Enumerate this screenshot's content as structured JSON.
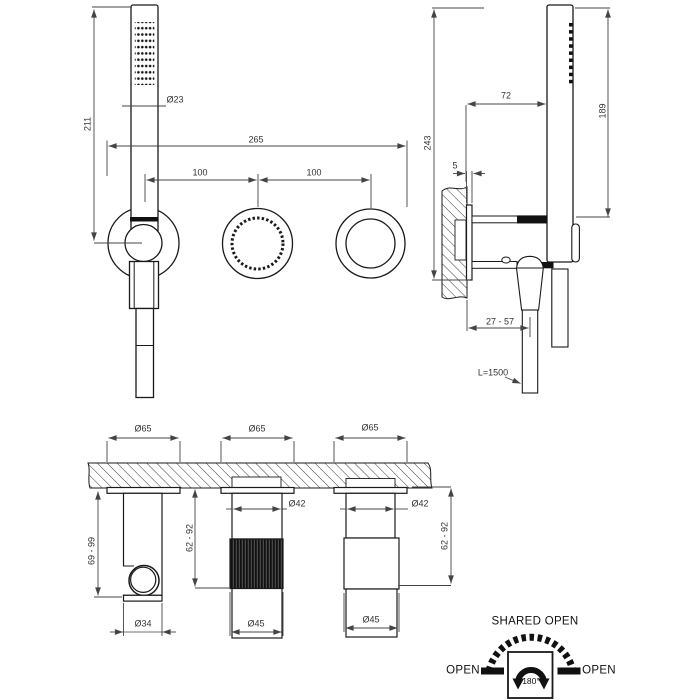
{
  "front_view": {
    "overall_height": "211",
    "handshower_diameter": "Ø23",
    "overall_width": "265",
    "spacing_left": "100",
    "spacing_right": "100"
  },
  "side_view": {
    "overall_height": "243",
    "wall_to_handshower": "72",
    "plate_thickness": "5",
    "handshower_height": "189",
    "depth_range": "27 - 57",
    "hose_length": "L=1500"
  },
  "bottom_view": {
    "flange_diameter_left": "Ø65",
    "flange_diameter_middle": "Ø65",
    "flange_diameter_right": "Ø65",
    "body_diameter_middle": "Ø42",
    "body_diameter_right": "Ø42",
    "knob_diameter_middle": "Ø45",
    "knob_diameter_right": "Ø45",
    "hook_diameter": "Ø34",
    "handle_range_left": "69 - 99",
    "handle_range_middle": "62 - 92",
    "handle_range_right": "62 - 92"
  },
  "legend": {
    "title": "SHARED OPEN",
    "open_left": "OPEN",
    "open_right": "OPEN",
    "rotation": "180°"
  },
  "colors": {
    "line": "#1a1a1a",
    "dim": "#444444",
    "background": "#ffffff"
  }
}
